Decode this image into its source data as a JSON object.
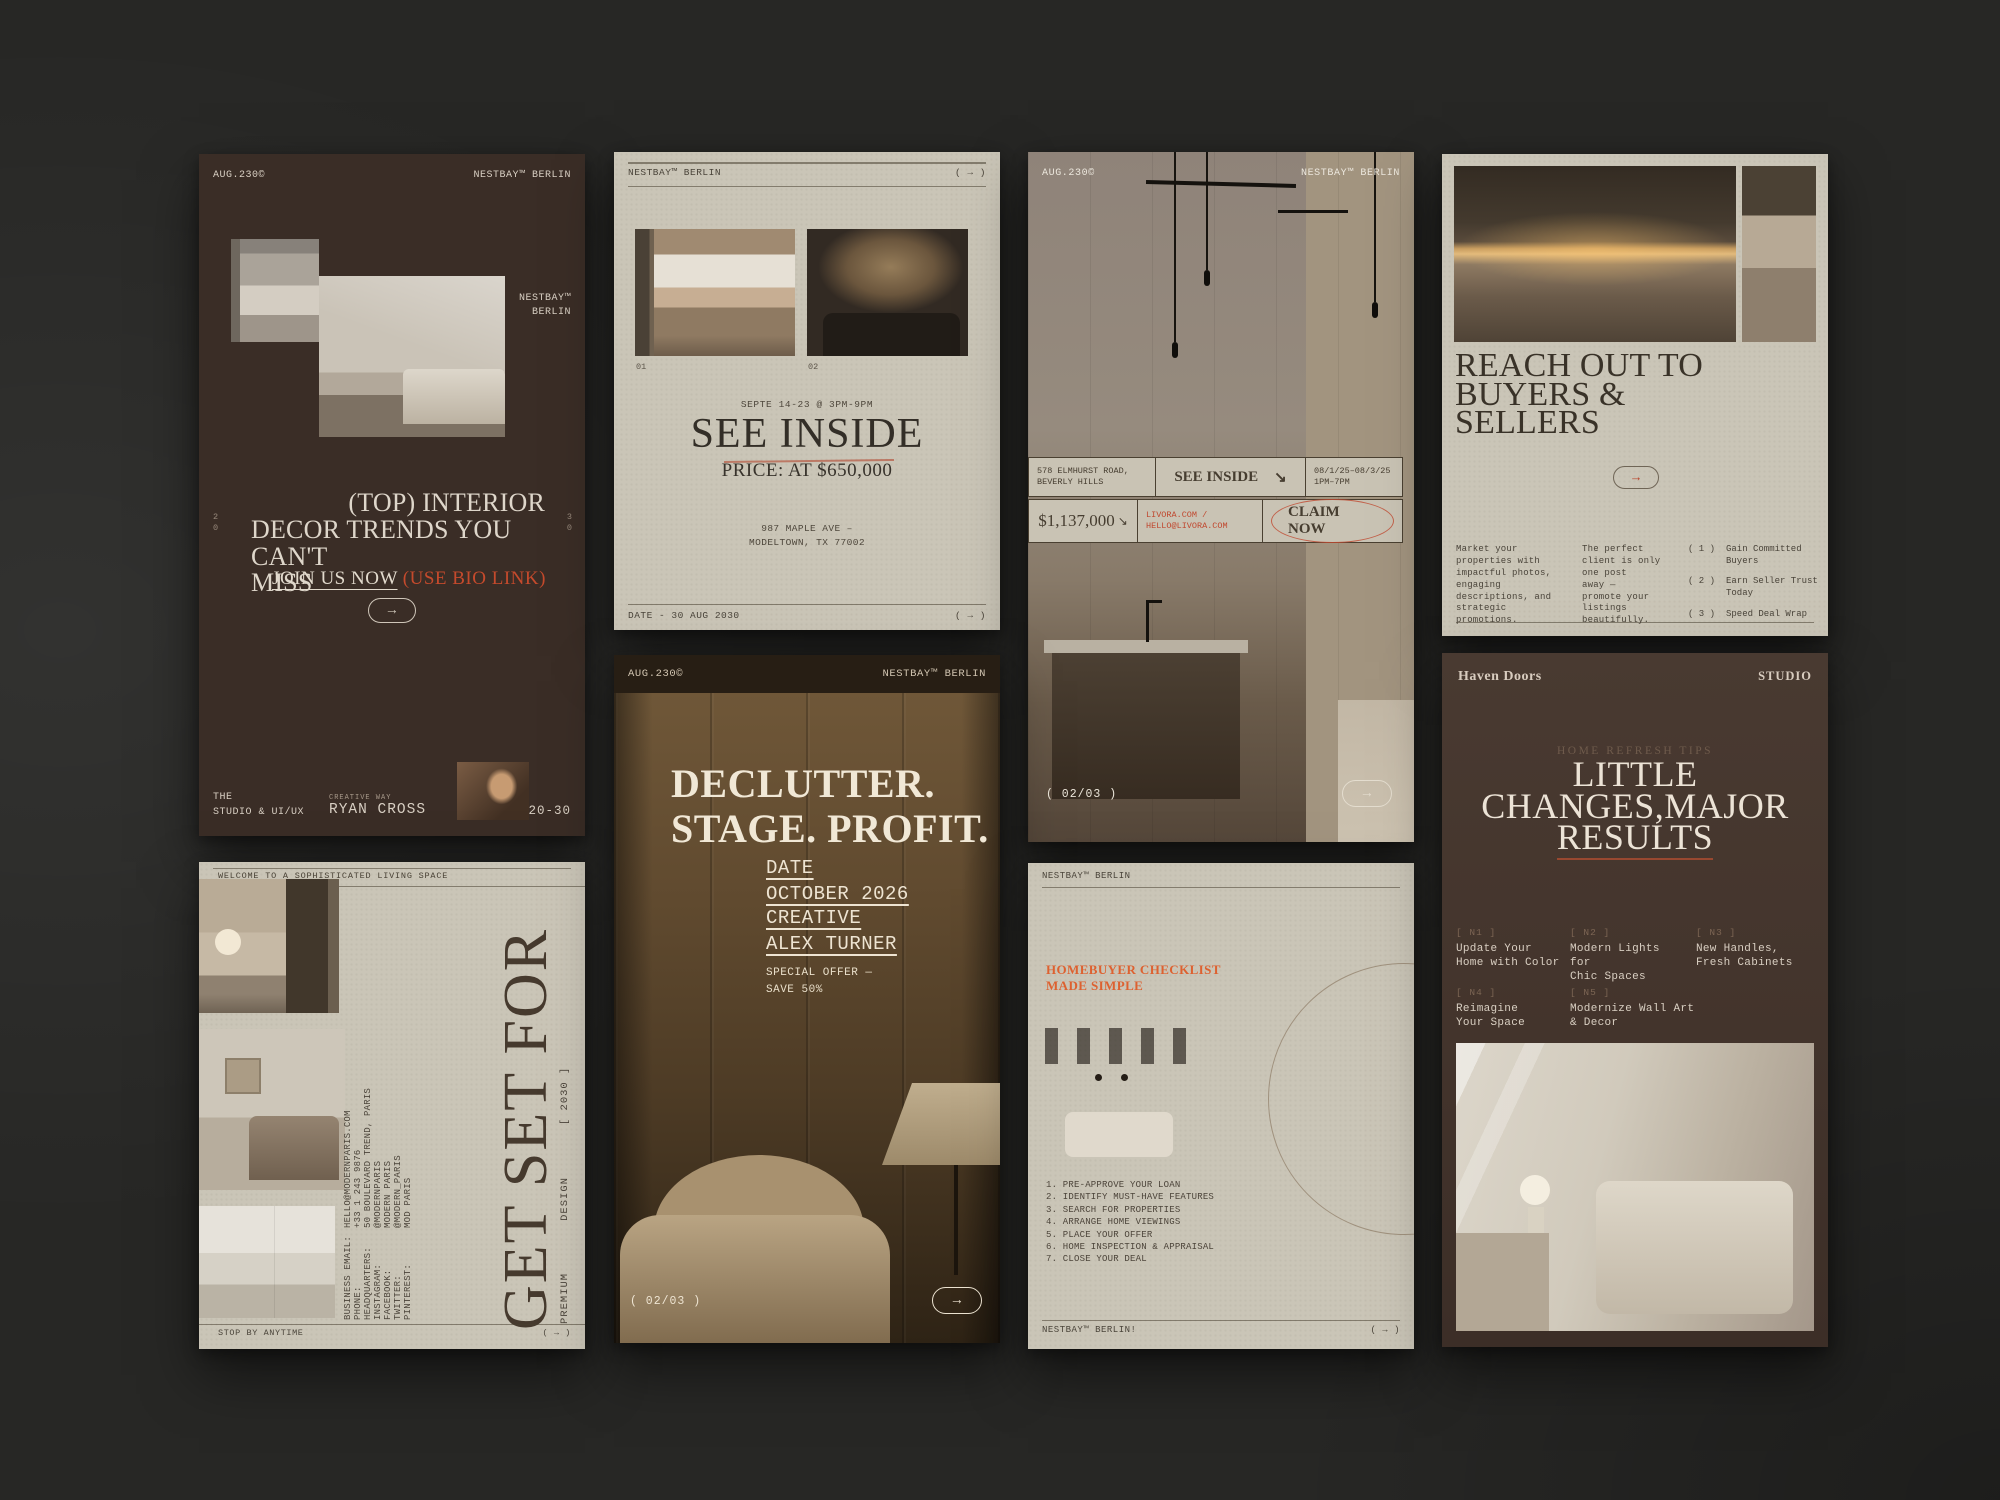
{
  "colors": {
    "accent_red": "#c4492c",
    "accent_orange": "#dd6130",
    "beige": "#cac5b7",
    "dark_brown": "#3a2d26",
    "canvas_bg": "#272725"
  },
  "card1": {
    "date_stamp": "AUG.230©",
    "brand": "NESTBAY™ BERLIN",
    "brand_stack": "NESTBAY™\nBERLIN",
    "side_left": "2\n0",
    "side_right": "3\n0",
    "headline_line1": "(TOP) INTERIOR",
    "headline_line2": "DECOR TRENDS YOU CAN'T",
    "headline_line3": "MISS",
    "cta_link": "JOIN US NOW",
    "cta_note": " (USE BIO LINK)",
    "arrow": "→",
    "footer_studio": "THE\nSTUDIO & UI/UX",
    "creative_label": "CREATIVE WAY",
    "creative_name": "RYAN CROSS",
    "range_tag": "20-30"
  },
  "card2": {
    "brand": "NESTBAY™ BERLIN",
    "header_arrow": "( → )",
    "photo1_num": "01",
    "photo2_num": "02",
    "schedule": "SEPTE 14-23 @ 3PM-9PM",
    "headline": "SEE INSIDE",
    "price": "PRICE: AT $650,000",
    "address": "987 MAPLE AVE –\nMODELTOWN, TX 77002",
    "footer_date": "DATE - 30 AUG 2030",
    "footer_arrow": "( → )"
  },
  "card3": {
    "date_stamp": "AUG.230©",
    "brand": "NESTBAY™ BERLIN",
    "address": "578 ELMHURST ROAD,\nBEVERLY HILLS",
    "see_inside": "SEE INSIDE",
    "see_inside_arrow": "↘",
    "open_dates": "08/1/25–08/3/25\n1PM–7PM",
    "price": "$1,137,000",
    "price_arrow": "↘",
    "contact": "LIVORA.COM /\nHELLO@LIVORA.COM",
    "claim": "CLAIM NOW",
    "page_indicator": "( 02/03 )",
    "arrow": "→"
  },
  "card4": {
    "headline": "REACH OUT TO BUYERS &\nSELLERS",
    "arrow": "→",
    "col1": "Market your\nproperties with\nimpactful photos,\nengaging\ndescriptions, and\nstrategic\npromotions.",
    "col2": "The perfect\nclient is only\none post\naway —\npromote your\nlistings\nbeautifully.",
    "benefits": [
      {
        "num": "( 1 )",
        "text": "Gain Committed\nBuyers"
      },
      {
        "num": "( 2 )",
        "text": "Earn Seller Trust\nToday"
      },
      {
        "num": "( 3 )",
        "text": "Speed Deal Wrap"
      }
    ]
  },
  "card5": {
    "top_note": "WELCOME TO A SOPHISTICATED LIVING SPACE",
    "contacts": [
      {
        "label": "BUSINESS EMAIL:",
        "value": "HELLO@MODERNPARIS.COM"
      },
      {
        "label": "PHONE:",
        "value": "+33 1 243 9876"
      },
      {
        "label": "HEADQUARTERS:",
        "value": "50 BOULEVARD TREND, PARIS"
      },
      {
        "label": "INSTAGRAM:",
        "value": "@MODERNPARIS"
      },
      {
        "label": "FACEBOOK:",
        "value": "MODERN PARIS"
      },
      {
        "label": "TWITTER:",
        "value": "@MODERN_PARIS"
      },
      {
        "label": "PINTEREST:",
        "value": "MOD PARIS"
      }
    ],
    "big_headline": "GET SET FOR",
    "premium": "PREMIUM",
    "design": "DESIGN",
    "year": "[ 2030 ]",
    "footer_note": "STOP BY ANYTIME",
    "footer_arrow": "( → )"
  },
  "card6": {
    "date_stamp": "AUG.230©",
    "brand": "NESTBAY™ BERLIN",
    "headline": "DECLUTTER.\nSTAGE. PROFIT.",
    "date_label": "DATE",
    "date_value": "OCTOBER 2026",
    "creative_label": "CREATIVE",
    "creative_value": "ALEX TURNER",
    "offer": "SPECIAL OFFER —\nSAVE 50%",
    "page_indicator": "( 02/03 )",
    "arrow": "→"
  },
  "card7": {
    "brand": "NESTBAY™ BERLIN",
    "title": "HOMEBUYER CHECKLIST\nMADE SIMPLE",
    "checklist": [
      "1. PRE-APPROVE YOUR LOAN",
      "2. IDENTIFY MUST-HAVE FEATURES",
      "3. SEARCH FOR PROPERTIES",
      "4. ARRANGE HOME VIEWINGS",
      "5. PLACE YOUR OFFER",
      "6. HOME INSPECTION & APPRAISAL",
      "7. CLOSE YOUR DEAL"
    ],
    "footer_brand": "NESTBAY™ BERLIN!",
    "footer_arrow": "( → )"
  },
  "card8": {
    "brand": "Haven Doors",
    "studio": "STUDIO",
    "kicker": "HOME REFRESH TIPS",
    "headline_line1": "LITTLE",
    "headline_line2": "CHANGES,MAJOR",
    "headline_line3": "RESULTS",
    "tips": [
      {
        "num": "[ N1 ]",
        "text": "Update Your\nHome with Color"
      },
      {
        "num": "[ N2 ]",
        "text": "Modern Lights for\nChic Spaces"
      },
      {
        "num": "[ N3 ]",
        "text": "New Handles,\nFresh Cabinets"
      },
      {
        "num": "[ N4 ]",
        "text": "Reimagine\nYour Space"
      },
      {
        "num": "[ N5 ]",
        "text": "Modernize Wall Art\n& Decor"
      }
    ]
  }
}
